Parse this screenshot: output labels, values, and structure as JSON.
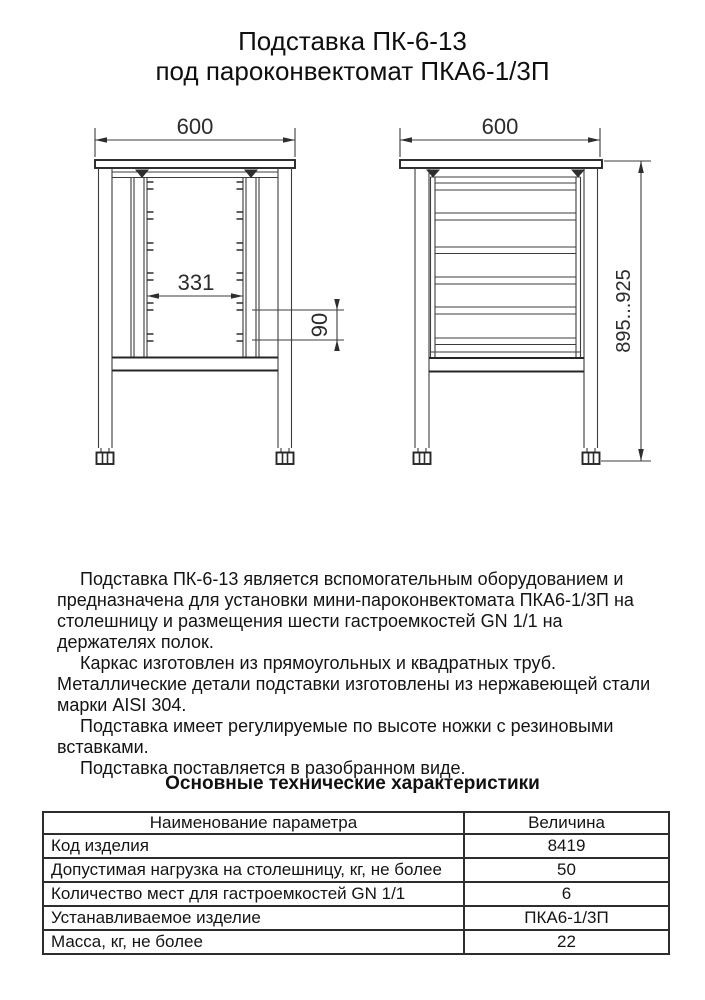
{
  "title": {
    "line1": "Подставка ПК-6-13",
    "line2": "под пароконвектомат ПКА6-1/3П"
  },
  "drawings": {
    "front_view": {
      "width_dim": "600",
      "rack_width_dim": "331",
      "shelf_pitch_dim": "90"
    },
    "side_view": {
      "width_dim": "600",
      "height_dim": "895...925"
    }
  },
  "description": {
    "paragraphs": [
      "Подставка ПК-6-13 является вспомогательным оборудованием и предназначена для установки мини-пароконвектомата ПКА6-1/3П на столешницу и размещения шести гастроемкостей GN 1/1 на держателях полок.",
      "Каркас изготовлен из прямоугольных и квадратных труб. Металлические детали подставки изготовлены из нержавеющей стали марки AISI 304.",
      "Подставка имеет регулируемые по высоте ножки с резиновыми вставками.",
      "Подставка поставляется в разобранном виде."
    ]
  },
  "specs": {
    "heading": "Основные технические характеристики",
    "table": {
      "headers": {
        "param": "Наименование параметра",
        "value": "Величина"
      },
      "rows": [
        {
          "param": "Код изделия",
          "value": "8419"
        },
        {
          "param": "Допустимая нагрузка на столешницу, кг, не более",
          "value": "50"
        },
        {
          "param": "Количество мест для гастроемкостей GN 1/1",
          "value": "6"
        },
        {
          "param": "Устанавливаемое изделие",
          "value": "ПКА6-1/3П"
        },
        {
          "param": "Масса, кг, не более",
          "value": "22"
        }
      ]
    }
  }
}
